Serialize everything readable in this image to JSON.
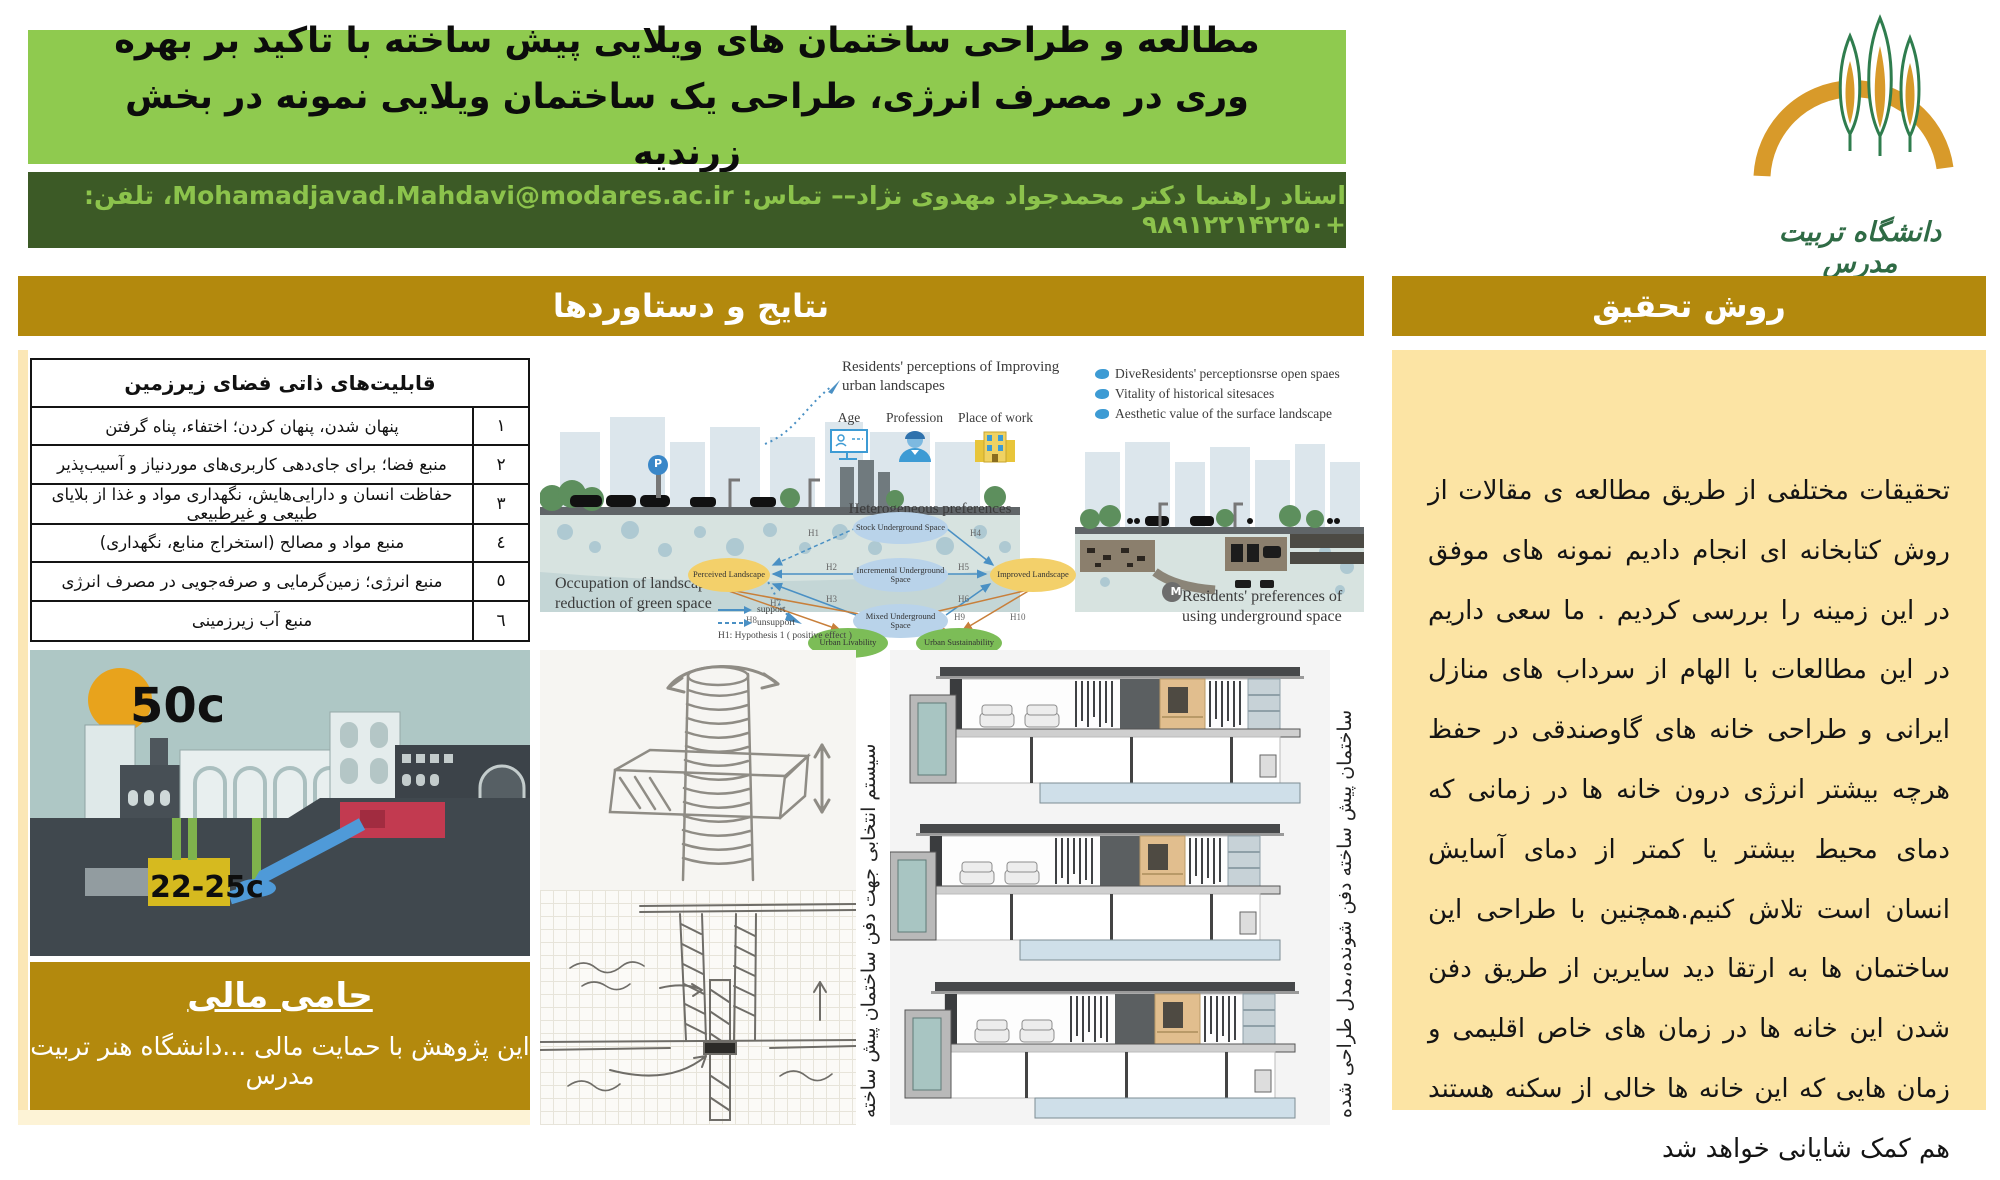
{
  "header": {
    "title": "مطالعه و طراحی ساختمان های ویلایی پیش ساخته با تاکید بر بهره وری در مصرف انرژی، طراحی یک ساختمان ویلایی نمونه در بخش زرندیه",
    "supervisor": "استاد راهنما دکتر محمدجواد مهدوی نژاد–– تماس: Mohamadjavad.Mahdavi@modares.ac.ir، تلفن: +۹۸۹۱۲۲۱۴۲۲۵۰",
    "logo_caption": "دانشگاه تربیت مدرس"
  },
  "sections": {
    "results_title": "نتایج و دستاوردها",
    "method_title": "روش تحقیق",
    "method_body": "تحقیقات مختلفی از طریق مطالعه ی مقالات از روش کتابخانه ای انجام دادیم نمونه های موفق در این زمینه را بررسی کردیم . ما سعی داریم در این مطالعات با الهام از سرداب های منازل ایرانی و طراحی خانه های گاوصندقی در حفظ هرچه بیشتر انرژی درون خانه ها در زمانی که دمای محیط بیشتر یا کمتر از دمای آسایش انسان است تلاش کنیم.همچنین با طراحی این ساختمان ها به ارتقا دید سایرین از طریق دفن شدن این خانه ها در زمان های خاص اقلیمی و زمان هایی که این خانه ها خالی از سکنه هستند هم کمک شایانی خواهد شد"
  },
  "table": {
    "title": "قابلیت‌های ذاتی فضای زیرزمین",
    "rows": [
      {
        "num": "۱",
        "text": "پنهان شدن، پنهان کردن؛ اختفاء، پناه گرفتن"
      },
      {
        "num": "۲",
        "text": "منبع فضا؛ برای جای‌دهی کاربری‌های موردنیاز و آسیب‌پذیر"
      },
      {
        "num": "۳",
        "text": "حفاظت انسان و دارایی‌هایش، نگهداری مواد و غذا از بلایای طبیعی و غیرطبیعی"
      },
      {
        "num": "٤",
        "text": "منبع مواد و مصالح (استخراج منابع، نگهداری)"
      },
      {
        "num": "٥",
        "text": "منبع انرژی؛ زمین‌گرمایی و صرفه‌جویی در مصرف انرژی"
      },
      {
        "num": "٦",
        "text": "منبع آب زیرزمینی"
      }
    ]
  },
  "figure": {
    "top_label": "Residents'  perceptions of Improving urban landscapes",
    "bullets": [
      "DiveResidents' perceptionsrse open spaes",
      "Vitality of historical sitesaces",
      "Aesthetic  value of the surface landscape"
    ],
    "icon_labels": [
      "Age",
      "Profession",
      "Place of work"
    ],
    "hetero": "Heterogeneous preferences",
    "left_caption": "Occupation of landscape and reduction of green space",
    "right_caption": "Residents'  preferences of using underground space",
    "parking": "P",
    "metro": "M",
    "network": {
      "stock": "Stock Underground Space",
      "incremental": "Incremental Underground Space",
      "mixed": "Mixed Underground Space",
      "perceived": "Perceived Landscape",
      "improved": "Improved Landscape",
      "livability": "Urban Livability",
      "sustainability": "Urban Sustainability",
      "legend_support": "support",
      "legend_unsupport": "unsupport",
      "legend_note": "H1: Hypothesis 1 ( positive effect )",
      "h": [
        "H1",
        "H2",
        "H3",
        "H4",
        "H5",
        "H6",
        "H7",
        "H8",
        "H9",
        "H10"
      ]
    }
  },
  "temp": {
    "surface": "50c",
    "underground": "22-25c"
  },
  "sketch": {
    "caption": "سیستم انتخابی جهت دفن ساختمان پیش ساخته"
  },
  "villa": {
    "caption": "ساختمان پیش ساخته دفن شونده،مدل طراحی شده"
  },
  "sponsor": {
    "title": "حامی مالی",
    "body": "این پژوهش با حمایت مالی ...دانشگاه هنر تربیت مدرس"
  },
  "colors": {
    "title_band": "#8fca4f",
    "supervisor_band": "#3c5a26",
    "supervisor_text": "#8cc34c",
    "section_header": "#b3890d",
    "method_bg": "#fce4a4",
    "sun": "#e8a31c",
    "underground_room": "#d6ba1f",
    "water_channel": "#4f9ad8",
    "hot_room": "#c23a50"
  }
}
